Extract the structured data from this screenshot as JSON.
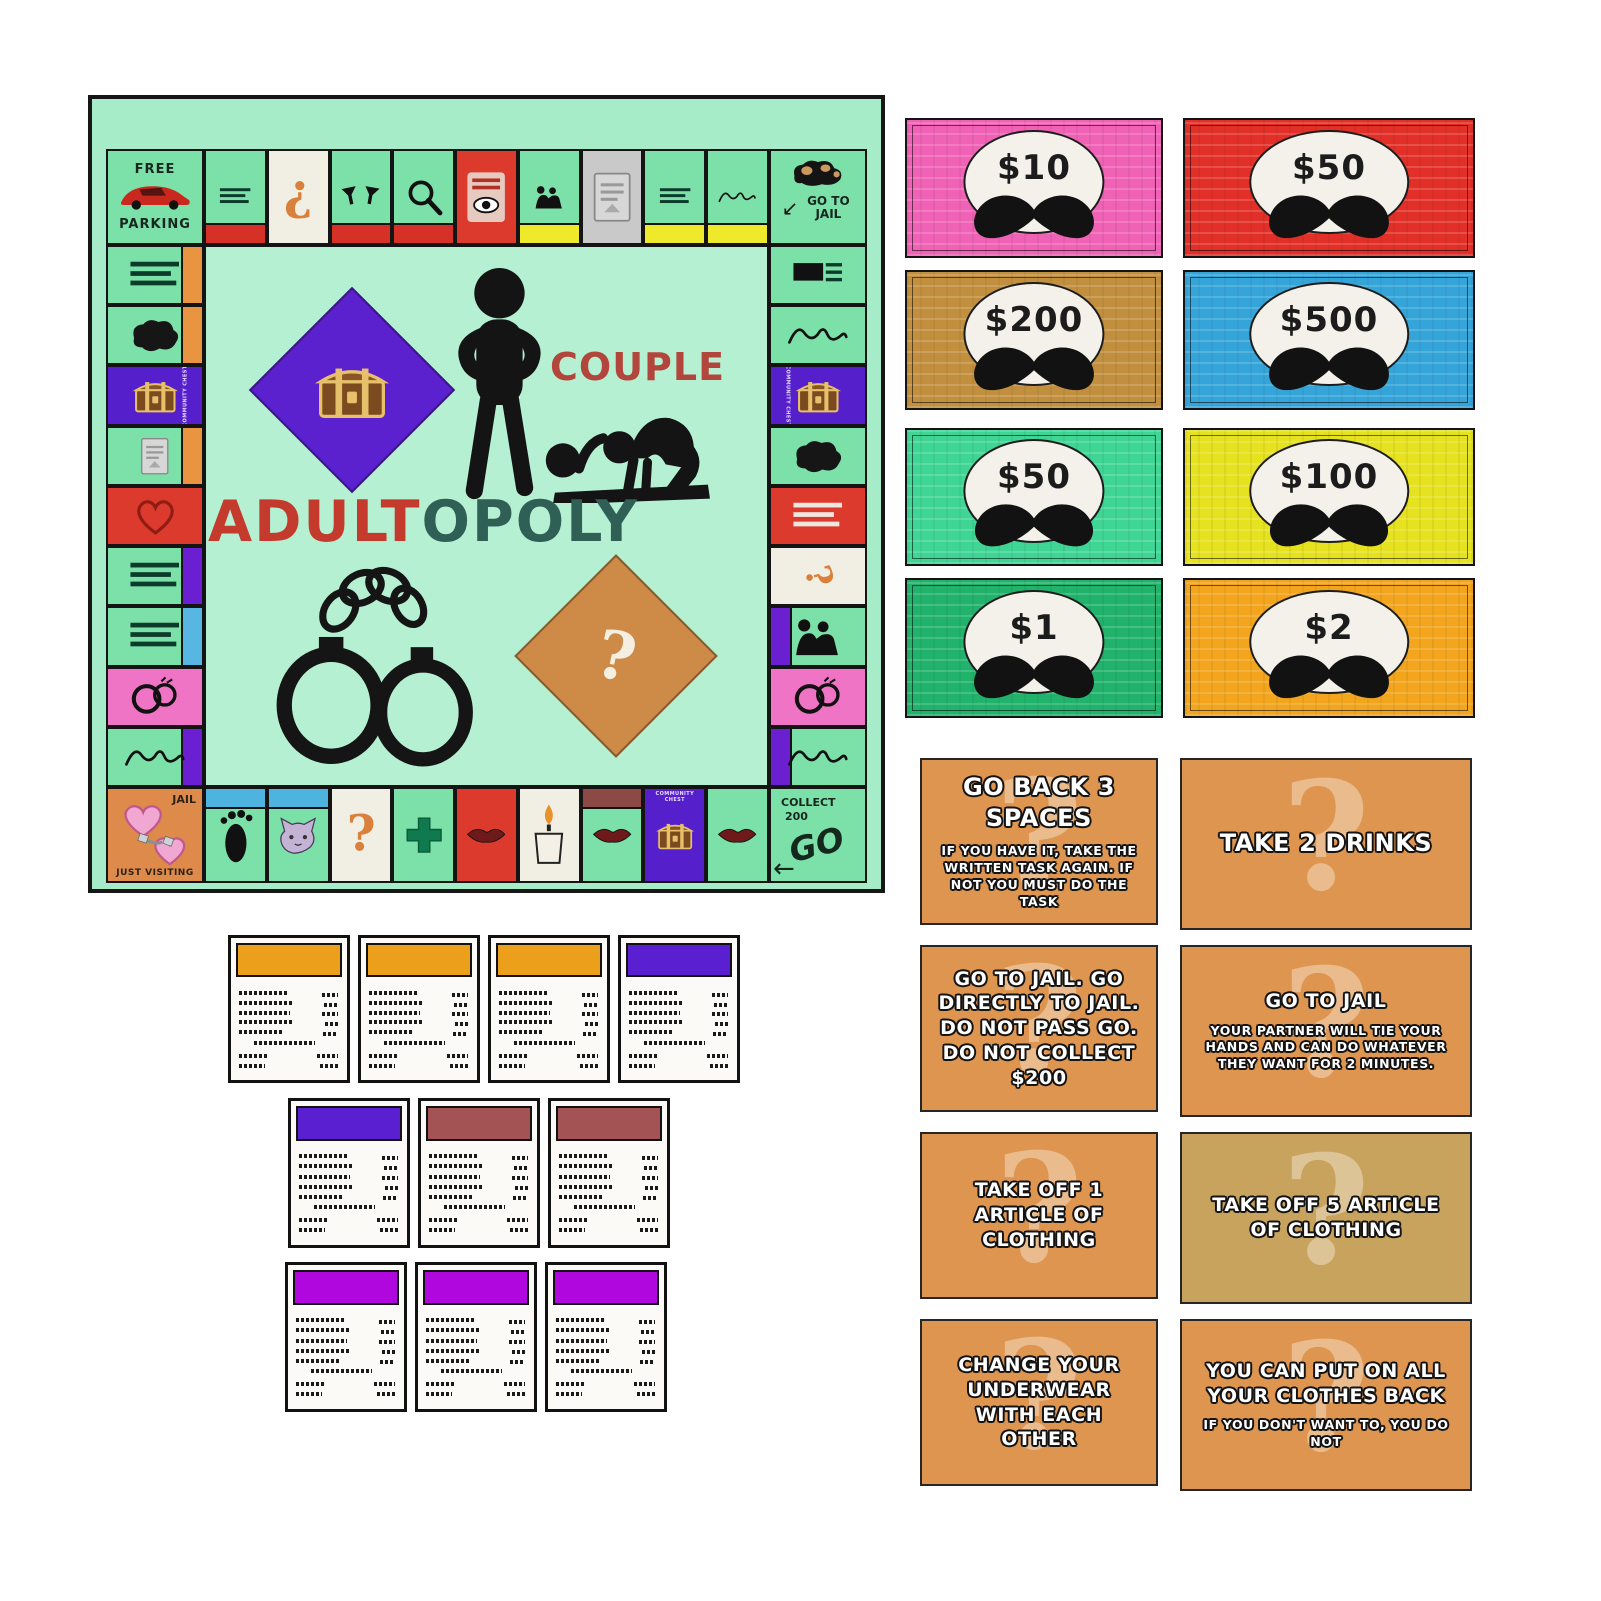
{
  "page": {
    "background": "#ffffff"
  },
  "board": {
    "bg": "#a7ecc8",
    "space_green": "#7ce0a9",
    "title": {
      "couple": "COUPLE",
      "couple_color": "#b2453c",
      "adult": "ADULT",
      "adult_color": "#c43b2e",
      "opoly": "OPOLY",
      "opoly_color": "#2f5f55"
    },
    "corners": {
      "free_parking": {
        "top": "FREE",
        "bottom": "PARKING"
      },
      "go_to_jail": {
        "label": "GO TO JAIL",
        "arrow": "↙"
      },
      "jail": {
        "label": "JAIL",
        "sub": "JUST VISITING"
      },
      "go": {
        "collect": "COLLECT",
        "amount": "200",
        "go": "GO",
        "arrow": "←"
      }
    },
    "community_chest_label": "COMMUNITY CHEST",
    "top_spaces": [
      {
        "bg": "#7ce0a9",
        "band": "#d53127",
        "icon": "textlines"
      },
      {
        "bg": "#f1eee3",
        "band": null,
        "icon": "q",
        "rot": 180
      },
      {
        "bg": "#7ce0a9",
        "band": "#d53127",
        "icon": "glasses"
      },
      {
        "bg": "#7ce0a9",
        "band": "#d53127",
        "icon": "magnifier"
      },
      {
        "bg": "#dc3a2d",
        "band": null,
        "icon": "eye"
      },
      {
        "bg": "#7ce0a9",
        "band": "#efe92c",
        "icon": "couple"
      },
      {
        "bg": "#c9c9c9",
        "band": null,
        "icon": "graycard"
      },
      {
        "bg": "#7ce0a9",
        "band": "#efe92c",
        "icon": "textlines"
      },
      {
        "bg": "#7ce0a9",
        "band": "#efe92c",
        "icon": "script"
      }
    ],
    "right_spaces": [
      {
        "bg": "#7ce0a9",
        "band": null,
        "icon": "flag"
      },
      {
        "bg": "#7ce0a9",
        "band": null,
        "icon": "script"
      },
      {
        "bg": "#5520cc",
        "band": null,
        "icon": "chest",
        "label": true
      },
      {
        "bg": "#7ce0a9",
        "band": null,
        "icon": "blob"
      },
      {
        "bg": "#dc3a2d",
        "band": null,
        "icon": "whitelines"
      },
      {
        "bg": "#f1eee3",
        "band": null,
        "icon": "q",
        "rot": 75
      },
      {
        "bg": "#7ce0a9",
        "band": "#6a1fd0",
        "icon": "couple"
      },
      {
        "bg": "#ef74c5",
        "band": null,
        "icon": "rings"
      },
      {
        "bg": "#7ce0a9",
        "band": "#6a1fd0",
        "icon": "script"
      }
    ],
    "bottom_spaces": [
      {
        "bg": "#7ce0a9",
        "band": "#4fb3e0",
        "icon": "foot"
      },
      {
        "bg": "#7ce0a9",
        "band": "#4fb3e0",
        "icon": "cat"
      },
      {
        "bg": "#f1eee3",
        "band": null,
        "icon": "q"
      },
      {
        "bg": "#7ce0a9",
        "band": null,
        "icon": "cross"
      },
      {
        "bg": "#dc3a2d",
        "band": null,
        "icon": "lips"
      },
      {
        "bg": "#f1eee3",
        "band": null,
        "icon": "candle"
      },
      {
        "bg": "#7ce0a9",
        "band": "#8b4a45",
        "icon": "lips"
      },
      {
        "bg": "#5520cc",
        "band": null,
        "icon": "chest",
        "label": true
      },
      {
        "bg": "#7ce0a9",
        "band": null,
        "icon": "lips"
      }
    ],
    "left_spaces": [
      {
        "bg": "#7ce0a9",
        "band": "#e89440",
        "icon": "textlines"
      },
      {
        "bg": "#7ce0a9",
        "band": "#e89440",
        "icon": "blob"
      },
      {
        "bg": "#5520cc",
        "band": null,
        "icon": "chest",
        "label": true
      },
      {
        "bg": "#7ce0a9",
        "band": "#e89440",
        "icon": "graycard"
      },
      {
        "bg": "#dc3a2d",
        "band": null,
        "icon": "heart"
      },
      {
        "bg": "#7ce0a9",
        "band": "#6a1fd0",
        "icon": "textlines"
      },
      {
        "bg": "#7ce0a9",
        "band": "#58b6e2",
        "icon": "textlines"
      },
      {
        "bg": "#ef74c5",
        "band": null,
        "icon": "rings"
      },
      {
        "bg": "#7ce0a9",
        "band": "#6a1fd0",
        "icon": "script"
      }
    ]
  },
  "money": {
    "bills": [
      {
        "value": "$10",
        "color": "#ef62b5"
      },
      {
        "value": "$50",
        "color": "#e23028"
      },
      {
        "value": "$200",
        "color": "#c28f3e"
      },
      {
        "value": "$500",
        "color": "#35a5d9"
      },
      {
        "value": "$50",
        "color": "#3fd695"
      },
      {
        "value": "$100",
        "color": "#e6e21f"
      },
      {
        "value": "$1",
        "color": "#21b36b"
      },
      {
        "value": "$2",
        "color": "#f2a51d"
      }
    ]
  },
  "chance": {
    "cards": [
      {
        "title": "GO BACK 3 SPACES",
        "body": "IF YOU HAVE IT, TAKE THE WRITTEN TASK AGAIN. IF NOT YOU MUST DO THE TASK",
        "bg": "#de9550"
      },
      {
        "title": "TAKE 2 DRINKS",
        "body": "",
        "bg": "#de9550"
      },
      {
        "title": "GO TO JAIL. GO DIRECTLY TO JAIL. DO NOT PASS GO. DO NOT COLLECT $200",
        "body": "",
        "bg": "#de9550"
      },
      {
        "title": "GO TO JAIL",
        "body": "YOUR PARTNER WILL TIE YOUR HANDS AND CAN DO WHATEVER THEY WANT FOR 2 MINUTES.",
        "bg": "#de9550"
      },
      {
        "title": "TAKE OFF 1 ARTICLE OF CLOTHING",
        "body": "",
        "bg": "#de9550"
      },
      {
        "title": "TAKE OFF 5 ARTICLE OF CLOTHING",
        "body": "",
        "bg": "#c8a35e"
      },
      {
        "title": "CHANGE YOUR UNDERWEAR WITH EACH OTHER",
        "body": "",
        "bg": "#de9550"
      },
      {
        "title": "YOU CAN PUT ON ALL YOUR CLOTHES BACK",
        "body": "IF YOU DON'T WANT TO, YOU DO NOT",
        "bg": "#de9550"
      }
    ]
  },
  "deeds": {
    "rows": [
      [
        "#ec9f1b",
        "#ec9f1b",
        "#ec9f1b",
        "#5a1fd0"
      ],
      [
        "#5a1fd0",
        "#a45354",
        "#a45354"
      ],
      [
        "#b007df",
        "#b007df",
        "#b007df"
      ]
    ]
  }
}
